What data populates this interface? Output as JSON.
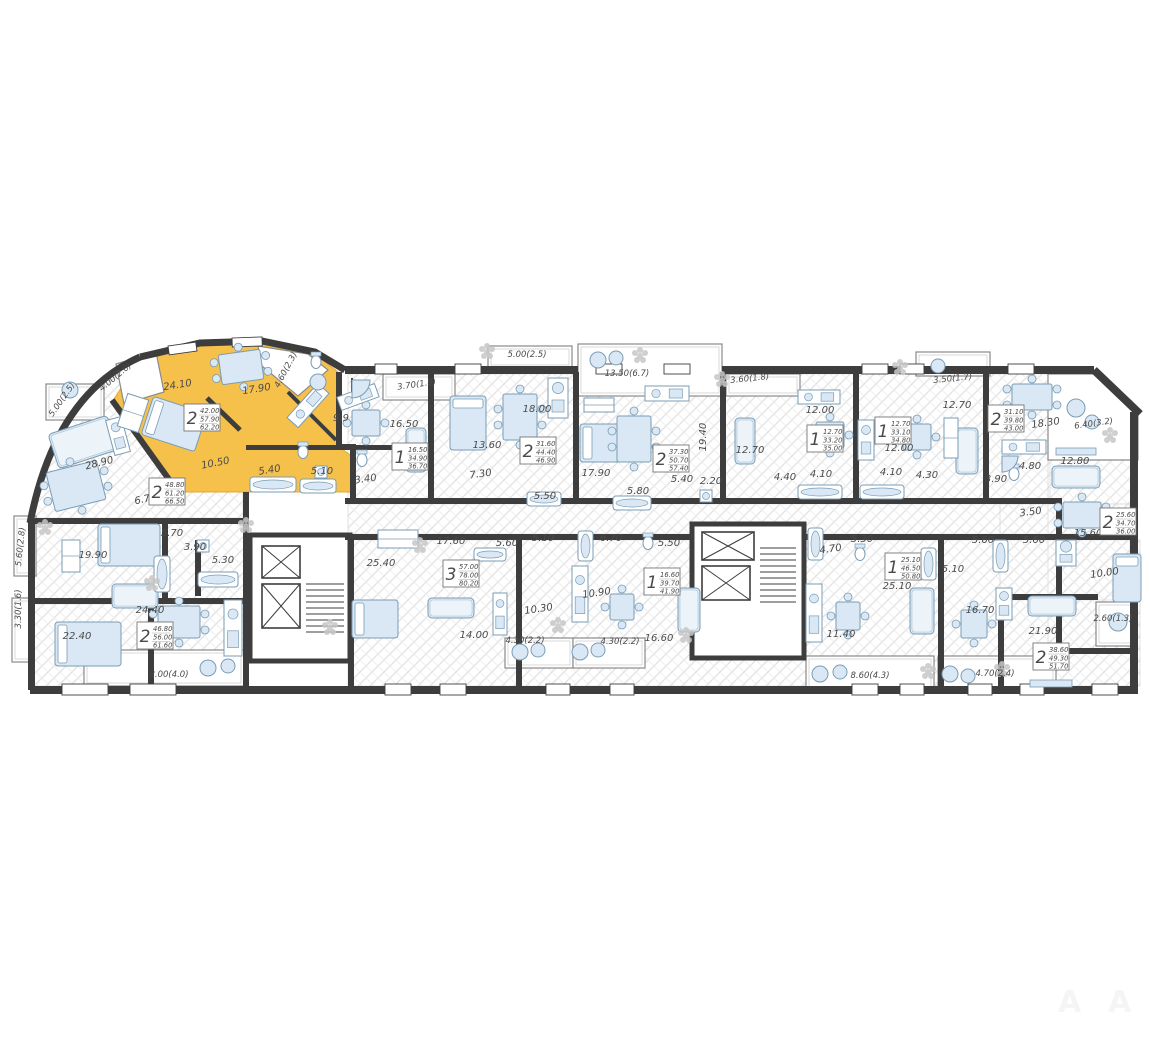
{
  "diagram": {
    "type": "floor-plan",
    "highlight_color": "#f6c14b",
    "wall_color": "#3d3d3d",
    "furniture_fill": "#d9e8f4",
    "furniture_stroke": "#7a9cb5",
    "hatch_color": "#e2e2e2"
  },
  "watermark": {
    "glyph": "A"
  },
  "apartments": [
    {
      "id": "apt-a",
      "rooms_count": "2",
      "areas": [
        "48.80",
        "61.20",
        "66.50"
      ],
      "highlighted": false,
      "box": {
        "x": 149,
        "y": 478
      },
      "rooms": [
        {
          "area": "28.90",
          "x": 100,
          "y": 466,
          "r": -14
        },
        {
          "area": "19.90",
          "x": 93,
          "y": 558,
          "r": 0
        },
        {
          "area": "6.70",
          "x": 146,
          "y": 502,
          "r": -12
        },
        {
          "area": "5.70",
          "x": 172,
          "y": 536,
          "r": 0
        }
      ],
      "balconies": [
        {
          "label": "5.00(2.5)",
          "x": 64,
          "y": 401,
          "r": -55
        },
        {
          "label": "5.60(2.8)",
          "x": 23,
          "y": 547,
          "r": -84
        }
      ]
    },
    {
      "id": "apt-b",
      "rooms_count": "2",
      "areas": [
        "42.00",
        "57.90",
        "62.20"
      ],
      "highlighted": true,
      "box": {
        "x": 184,
        "y": 404
      },
      "rooms": [
        {
          "area": "24.10",
          "x": 178,
          "y": 388,
          "r": -9
        },
        {
          "area": "17.90",
          "x": 257,
          "y": 392,
          "r": -9
        },
        {
          "area": "10.50",
          "x": 216,
          "y": 466,
          "r": -11
        },
        {
          "area": "5.40",
          "x": 270,
          "y": 473,
          "r": -9
        }
      ],
      "balconies": [
        {
          "label": "4.00(2.0)",
          "x": 117,
          "y": 379,
          "r": -40
        },
        {
          "label": "4.60(2.3)",
          "x": 288,
          "y": 371,
          "r": -62
        }
      ]
    },
    {
      "id": "apt-c",
      "rooms_count": "1",
      "areas": [
        "16.50",
        "34.90",
        "36.70"
      ],
      "highlighted": false,
      "box": {
        "x": 392,
        "y": 443
      },
      "rooms": [
        {
          "area": "16.50",
          "x": 404,
          "y": 427,
          "r": 0
        },
        {
          "area": "9.9",
          "x": 341,
          "y": 421,
          "r": 0
        },
        {
          "area": "5.10",
          "x": 322,
          "y": 474,
          "r": 0
        },
        {
          "area": "3.40",
          "x": 366,
          "y": 482,
          "r": -8
        }
      ],
      "balconies": [
        {
          "label": "3.70(1.8)",
          "x": 417,
          "y": 387,
          "r": -8
        }
      ]
    },
    {
      "id": "apt-d",
      "rooms_count": "2",
      "areas": [
        "31.60",
        "44.40",
        "46.90"
      ],
      "highlighted": false,
      "box": {
        "x": 520,
        "y": 437
      },
      "rooms": [
        {
          "area": "18.00",
          "x": 537,
          "y": 412,
          "r": 0
        },
        {
          "area": "13.60",
          "x": 487,
          "y": 448,
          "r": 0
        },
        {
          "area": "7.30",
          "x": 481,
          "y": 477,
          "r": -8
        },
        {
          "area": "5.50",
          "x": 545,
          "y": 499,
          "r": 0
        }
      ],
      "balconies": [
        {
          "label": "5.00(2.5)",
          "x": 527,
          "y": 357,
          "r": 0
        }
      ]
    },
    {
      "id": "apt-e",
      "rooms_count": "2",
      "areas": [
        "37.30",
        "50.70",
        "57.40"
      ],
      "highlighted": false,
      "box": {
        "x": 653,
        "y": 445
      },
      "rooms": [
        {
          "area": "17.90",
          "x": 596,
          "y": 476,
          "r": 0
        },
        {
          "area": "19.40",
          "x": 706,
          "y": 437,
          "r": -90
        },
        {
          "area": "5.80",
          "x": 638,
          "y": 494,
          "r": 0
        },
        {
          "area": "5.40",
          "x": 682,
          "y": 482,
          "r": 0
        },
        {
          "area": "2.20",
          "x": 711,
          "y": 484,
          "r": 0
        }
      ],
      "balconies": [
        {
          "label": "13.50(6.7)",
          "x": 627,
          "y": 376,
          "r": 0
        }
      ]
    },
    {
      "id": "apt-f",
      "rooms_count": "1",
      "areas": [
        "12.70",
        "33.20",
        "35.00"
      ],
      "highlighted": false,
      "box": {
        "x": 807,
        "y": 425
      },
      "rooms": [
        {
          "area": "12.70",
          "x": 750,
          "y": 453,
          "r": 0
        },
        {
          "area": "12.00",
          "x": 820,
          "y": 413,
          "r": 0
        },
        {
          "area": "4.40",
          "x": 785,
          "y": 480,
          "r": 0
        },
        {
          "area": "4.10",
          "x": 821,
          "y": 477,
          "r": 0
        }
      ],
      "balconies": [
        {
          "label": "3.60(1.8)",
          "x": 750,
          "y": 381,
          "r": -6
        }
      ]
    },
    {
      "id": "apt-g",
      "rooms_count": "1",
      "areas": [
        "12.70",
        "33.10",
        "34.80"
      ],
      "highlighted": false,
      "box": {
        "x": 875,
        "y": 417
      },
      "rooms": [
        {
          "area": "12.70",
          "x": 957,
          "y": 408,
          "r": 0
        },
        {
          "area": "12.00",
          "x": 899,
          "y": 451,
          "r": 0
        },
        {
          "area": "4.10",
          "x": 891,
          "y": 475,
          "r": 0
        },
        {
          "area": "4.30",
          "x": 927,
          "y": 478,
          "r": 0
        }
      ],
      "balconies": [
        {
          "label": "3.50(1.7)",
          "x": 953,
          "y": 381,
          "r": -6
        }
      ]
    },
    {
      "id": "apt-h",
      "rooms_count": "2",
      "areas": [
        "31.10",
        "39.80",
        "43.00"
      ],
      "highlighted": false,
      "box": {
        "x": 988,
        "y": 405
      },
      "rooms": [
        {
          "area": "18.30",
          "x": 1046,
          "y": 426,
          "r": -8
        },
        {
          "area": "12.80",
          "x": 1075,
          "y": 464,
          "r": 0
        },
        {
          "area": "4.80",
          "x": 1030,
          "y": 469,
          "r": 0
        },
        {
          "area": "3.90",
          "x": 996,
          "y": 482,
          "r": 0
        }
      ],
      "balconies": [
        {
          "label": "6.40(3.2)",
          "x": 1094,
          "y": 426,
          "r": -8
        }
      ]
    },
    {
      "id": "apt-i",
      "rooms_count": "2",
      "areas": [
        "25.60",
        "34.70",
        "36.00"
      ],
      "highlighted": false,
      "box": {
        "x": 1100,
        "y": 508
      },
      "rooms": [
        {
          "area": "15.60",
          "x": 1088,
          "y": 536,
          "r": 0
        },
        {
          "area": "10.00",
          "x": 1105,
          "y": 576,
          "r": -8
        },
        {
          "area": "5.60",
          "x": 1034,
          "y": 543,
          "r": 0
        },
        {
          "area": "3.50",
          "x": 1031,
          "y": 515,
          "r": -8
        }
      ],
      "balconies": [
        {
          "label": "2.60(1.3)",
          "x": 1113,
          "y": 621,
          "r": 0
        }
      ]
    },
    {
      "id": "apt-j",
      "rooms_count": "1",
      "areas": [
        "25.10",
        "46.50",
        "50.80"
      ],
      "highlighted": false,
      "box": {
        "x": 885,
        "y": 553
      },
      "rooms": [
        {
          "area": "25.10",
          "x": 897,
          "y": 589,
          "r": 0
        },
        {
          "area": "11.40",
          "x": 841,
          "y": 637,
          "r": 0
        },
        {
          "area": "5.30",
          "x": 862,
          "y": 542,
          "r": 0
        },
        {
          "area": "4.70",
          "x": 831,
          "y": 552,
          "r": -8
        }
      ],
      "balconies": [
        {
          "label": "8.60(4.3)",
          "x": 870,
          "y": 678,
          "r": 0
        }
      ]
    },
    {
      "id": "apt-k",
      "rooms_count": "1",
      "areas": [
        "16.60",
        "39.70",
        "41.90"
      ],
      "highlighted": false,
      "box": {
        "x": 644,
        "y": 568
      },
      "rooms": [
        {
          "area": "16.60",
          "x": 659,
          "y": 641,
          "r": 0
        },
        {
          "area": "10.90",
          "x": 597,
          "y": 596,
          "r": -8
        },
        {
          "area": "6.70",
          "x": 611,
          "y": 541,
          "r": 0
        },
        {
          "area": "5.50",
          "x": 669,
          "y": 546,
          "r": 0
        }
      ],
      "balconies": [
        {
          "label": "4.30(2.2)",
          "x": 620,
          "y": 644,
          "r": 0
        }
      ]
    },
    {
      "id": "apt-l",
      "rooms_count": "3",
      "areas": [
        "57.00",
        "78.00",
        "80.20"
      ],
      "highlighted": false,
      "box": {
        "x": 443,
        "y": 560
      },
      "rooms": [
        {
          "area": "25.40",
          "x": 381,
          "y": 566,
          "r": 0
        },
        {
          "area": "17.60",
          "x": 451,
          "y": 544,
          "r": 0
        },
        {
          "area": "14.00",
          "x": 474,
          "y": 638,
          "r": 0
        },
        {
          "area": "10.30",
          "x": 539,
          "y": 612,
          "r": -8
        },
        {
          "area": "5.60",
          "x": 507,
          "y": 546,
          "r": 0
        },
        {
          "area": "5.10",
          "x": 543,
          "y": 541,
          "r": 0
        }
      ],
      "balconies": [
        {
          "label": "4.30(2.2)",
          "x": 525,
          "y": 643,
          "r": 0
        }
      ]
    },
    {
      "id": "apt-m",
      "rooms_count": "2",
      "areas": [
        "46.80",
        "56.00",
        "61.60"
      ],
      "highlighted": false,
      "box": {
        "x": 137,
        "y": 622
      },
      "rooms": [
        {
          "area": "22.40",
          "x": 77,
          "y": 639,
          "r": 0
        },
        {
          "area": "24.40",
          "x": 150,
          "y": 613,
          "r": 0
        },
        {
          "area": "3.90",
          "x": 195,
          "y": 550,
          "r": 0
        },
        {
          "area": "5.30",
          "x": 223,
          "y": 563,
          "r": 0
        }
      ],
      "balconies": [
        {
          "label": "3.30(1.6)",
          "x": 21,
          "y": 609,
          "r": -90
        },
        {
          "label": "8.00(4.0)",
          "x": 169,
          "y": 677,
          "r": 0
        }
      ]
    },
    {
      "id": "apt-n",
      "rooms_count": "2",
      "areas": [
        "38.60",
        "49.30",
        "51.70"
      ],
      "highlighted": false,
      "box": {
        "x": 1033,
        "y": 643
      },
      "rooms": [
        {
          "area": "21.90",
          "x": 1043,
          "y": 634,
          "r": 0
        },
        {
          "area": "16.70",
          "x": 980,
          "y": 613,
          "r": 0
        },
        {
          "area": "5.60",
          "x": 983,
          "y": 543,
          "r": 0
        },
        {
          "area": "5.10",
          "x": 953,
          "y": 572,
          "r": 0
        }
      ],
      "balconies": [
        {
          "label": "4.70(2.4)",
          "x": 995,
          "y": 676,
          "r": 0
        }
      ]
    }
  ]
}
